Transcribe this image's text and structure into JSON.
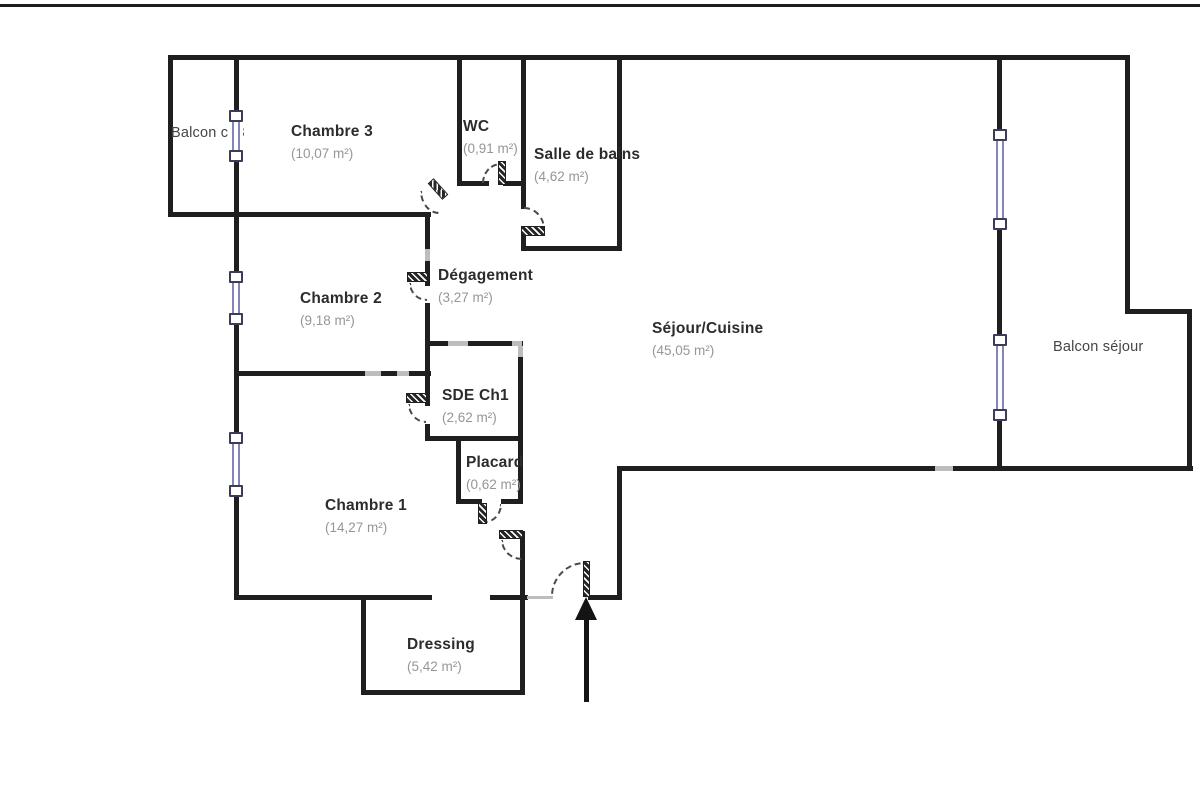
{
  "plan": {
    "colors": {
      "wall": "#1f1f1f",
      "wall_faded": "#bdbdbd",
      "window_rail": "#8286b8",
      "window_cap_border": "#3c3c58",
      "door_arc": "#4a4a4a",
      "room_name": "#2c2c2c",
      "room_area": "#969696",
      "balcony_label": "#454545"
    },
    "frame_line": {
      "x": 0,
      "y": 4,
      "w": 1200,
      "h": 3
    },
    "rooms": [
      {
        "id": "balcon-ch3",
        "name": "Balcon ch3",
        "area": "",
        "x": 171,
        "y": 126,
        "bold": false
      },
      {
        "id": "chambre-3",
        "name": "Chambre 3",
        "area": "(10,07 m²)",
        "x": 291,
        "y": 124,
        "bold": true
      },
      {
        "id": "wc",
        "name": "WC",
        "area": "(0,91 m²)",
        "x": 463,
        "y": 119,
        "bold": true
      },
      {
        "id": "salle-de-bains",
        "name": "Salle de bains",
        "area": "(4,62 m²)",
        "x": 534,
        "y": 147,
        "bold": true
      },
      {
        "id": "chambre-2",
        "name": "Chambre 2",
        "area": "(9,18 m²)",
        "x": 300,
        "y": 291,
        "bold": true
      },
      {
        "id": "degagement",
        "name": "Dégagement",
        "area": "(3,27 m²)",
        "x": 438,
        "y": 268,
        "bold": true
      },
      {
        "id": "sejour-cuisine",
        "name": "Séjour/Cuisine",
        "area": "(45,05 m²)",
        "x": 652,
        "y": 321,
        "bold": true
      },
      {
        "id": "sde-ch1",
        "name": "SDE Ch1",
        "area": "(2,62 m²)",
        "x": 442,
        "y": 388,
        "bold": true
      },
      {
        "id": "placard",
        "name": "Placard",
        "area": "(0,62 m²)",
        "x": 466,
        "y": 455,
        "bold": true
      },
      {
        "id": "chambre-1",
        "name": "Chambre 1",
        "area": "(14,27 m²)",
        "x": 325,
        "y": 498,
        "bold": true
      },
      {
        "id": "dressing",
        "name": "Dressing",
        "area": "(5,42 m²)",
        "x": 407,
        "y": 637,
        "bold": true
      },
      {
        "id": "balcon-sejour",
        "name": "Balcon séjour",
        "area": "",
        "x": 1053,
        "y": 340,
        "bold": false
      }
    ],
    "walls": [
      {
        "id": "outer-top",
        "x": 168,
        "y": 55,
        "w": 962,
        "h": 5
      },
      {
        "id": "outer-left",
        "x": 168,
        "y": 55,
        "w": 5,
        "h": 162
      },
      {
        "id": "chambre3-bottom",
        "x": 168,
        "y": 212,
        "w": 263,
        "h": 5
      },
      {
        "id": "west-spine",
        "x": 234,
        "y": 55,
        "w": 5,
        "h": 545
      },
      {
        "id": "wc-west",
        "x": 457,
        "y": 55,
        "w": 5,
        "h": 131
      },
      {
        "id": "wc-bottom-left",
        "x": 457,
        "y": 181,
        "w": 32,
        "h": 5
      },
      {
        "id": "wc-bottom-right",
        "x": 503,
        "y": 181,
        "w": 23,
        "h": 5
      },
      {
        "id": "sdb-west",
        "x": 521,
        "y": 55,
        "w": 5,
        "h": 154
      },
      {
        "id": "sdb-west-stub",
        "x": 521,
        "y": 231,
        "w": 5,
        "h": 20
      },
      {
        "id": "sdb-bottom",
        "x": 521,
        "y": 246,
        "w": 101,
        "h": 5
      },
      {
        "id": "sdb-east",
        "x": 617,
        "y": 55,
        "w": 5,
        "h": 196
      },
      {
        "id": "degagement-west-a",
        "x": 425,
        "y": 212,
        "w": 5,
        "h": 74
      },
      {
        "id": "degagement-west-b",
        "x": 425,
        "y": 303,
        "w": 5,
        "h": 103
      },
      {
        "id": "degagement-west-c",
        "x": 425,
        "y": 424,
        "w": 5,
        "h": 17
      },
      {
        "id": "sde-top",
        "x": 425,
        "y": 341,
        "w": 98,
        "h": 5
      },
      {
        "id": "sde-east",
        "x": 518,
        "y": 341,
        "w": 5,
        "h": 163
      },
      {
        "id": "sde-bottom",
        "x": 425,
        "y": 436,
        "w": 98,
        "h": 5
      },
      {
        "id": "placard-west",
        "x": 456,
        "y": 436,
        "w": 5,
        "h": 68
      },
      {
        "id": "placard-bottom-left",
        "x": 456,
        "y": 499,
        "w": 26,
        "h": 5
      },
      {
        "id": "placard-bottom-right",
        "x": 501,
        "y": 499,
        "w": 22,
        "h": 5
      },
      {
        "id": "ch1-ch2-divider",
        "x": 234,
        "y": 371,
        "w": 197,
        "h": 5
      },
      {
        "id": "chambre1-bottom",
        "x": 234,
        "y": 595,
        "w": 198,
        "h": 5
      },
      {
        "id": "hall-bottom-left",
        "x": 490,
        "y": 595,
        "w": 38,
        "h": 5
      },
      {
        "id": "hall-east",
        "x": 520,
        "y": 531,
        "w": 5,
        "h": 164
      },
      {
        "id": "dressing-west",
        "x": 361,
        "y": 595,
        "w": 5,
        "h": 100
      },
      {
        "id": "dressing-bottom",
        "x": 361,
        "y": 690,
        "w": 164,
        "h": 5
      },
      {
        "id": "entry-bottom-right",
        "x": 588,
        "y": 595,
        "w": 34,
        "h": 5
      },
      {
        "id": "entry-east",
        "x": 617,
        "y": 466,
        "w": 5,
        "h": 134
      },
      {
        "id": "sejour-balcony-bottom",
        "x": 617,
        "y": 466,
        "w": 576,
        "h": 5
      },
      {
        "id": "sejour-window-wall",
        "x": 997,
        "y": 55,
        "w": 5,
        "h": 416
      },
      {
        "id": "balcony-east-upper",
        "x": 1125,
        "y": 55,
        "w": 5,
        "h": 259
      },
      {
        "id": "balcony-step",
        "x": 1125,
        "y": 309,
        "w": 67,
        "h": 5
      },
      {
        "id": "balcony-east-lower",
        "x": 1187,
        "y": 309,
        "w": 5,
        "h": 162
      }
    ],
    "faded_segments": [
      {
        "x": 365,
        "y": 371,
        "w": 16,
        "h": 5
      },
      {
        "x": 397,
        "y": 371,
        "w": 12,
        "h": 5
      },
      {
        "x": 448,
        "y": 341,
        "w": 20,
        "h": 5
      },
      {
        "x": 512,
        "y": 341,
        "w": 10,
        "h": 5
      },
      {
        "x": 518,
        "y": 346,
        "w": 5,
        "h": 11
      },
      {
        "x": 425,
        "y": 249,
        "w": 5,
        "h": 12
      },
      {
        "x": 935,
        "y": 466,
        "w": 18,
        "h": 5
      },
      {
        "x": 527,
        "y": 596,
        "w": 26,
        "h": 3
      }
    ],
    "windows": [
      {
        "id": "window-balcon-ch3",
        "x": 236,
        "y1": 110,
        "y2": 162
      },
      {
        "id": "window-chambre-2",
        "x": 236,
        "y1": 271,
        "y2": 325
      },
      {
        "id": "window-chambre-1",
        "x": 236,
        "y1": 432,
        "y2": 497
      },
      {
        "id": "window-sejour-1",
        "x": 1000,
        "y1": 129,
        "y2": 230
      },
      {
        "id": "window-sejour-2",
        "x": 1000,
        "y1": 334,
        "y2": 421
      }
    ],
    "doors": [
      {
        "id": "door-chambre-3",
        "leaf": {
          "x": 427,
          "y": 185,
          "w": 22,
          "h": 8,
          "rot": 48
        },
        "arc": {
          "x": 420,
          "y": 191,
          "w": 19,
          "h": 23,
          "q": "bl"
        }
      },
      {
        "id": "door-wc",
        "leaf": {
          "x": 498,
          "y": 161,
          "w": 8,
          "h": 24,
          "rot": 0
        },
        "arc": {
          "x": 482,
          "y": 163,
          "w": 19,
          "h": 20,
          "q": "tl"
        }
      },
      {
        "id": "door-sdb",
        "leaf": {
          "x": 521,
          "y": 226,
          "w": 24,
          "h": 10,
          "rot": 0
        },
        "arc": {
          "x": 524,
          "y": 207,
          "w": 21,
          "h": 22,
          "q": "tr"
        }
      },
      {
        "id": "door-chambre-2",
        "leaf": {
          "x": 407,
          "y": 272,
          "w": 21,
          "h": 10,
          "rot": 0
        },
        "arc": {
          "x": 409,
          "y": 283,
          "w": 18,
          "h": 18,
          "q": "bl"
        }
      },
      {
        "id": "door-sde-ch1",
        "leaf": {
          "x": 406,
          "y": 393,
          "w": 21,
          "h": 10,
          "rot": 0
        },
        "arc": {
          "x": 408,
          "y": 404,
          "w": 18,
          "h": 19,
          "q": "bl"
        }
      },
      {
        "id": "door-placard",
        "leaf": {
          "x": 478,
          "y": 503,
          "w": 9,
          "h": 21,
          "rot": 0
        },
        "arc": {
          "x": 485,
          "y": 504,
          "w": 17,
          "h": 19,
          "q": "br"
        }
      },
      {
        "id": "door-chambre-1",
        "leaf": {
          "x": 499,
          "y": 530,
          "w": 24,
          "h": 9,
          "rot": 0
        },
        "arc": {
          "x": 501,
          "y": 540,
          "w": 21,
          "h": 20,
          "q": "bl"
        }
      },
      {
        "id": "door-entry",
        "leaf": {
          "x": 583,
          "y": 561,
          "w": 7,
          "h": 36,
          "rot": 0
        },
        "arc": {
          "x": 551,
          "y": 562,
          "w": 34,
          "h": 34,
          "q": "tl"
        }
      }
    ],
    "entry_arrow": {
      "head_x": 575,
      "head_y": 597,
      "shaft_x": 584,
      "shaft_y": 619,
      "shaft_w": 5,
      "shaft_h": 83
    }
  }
}
